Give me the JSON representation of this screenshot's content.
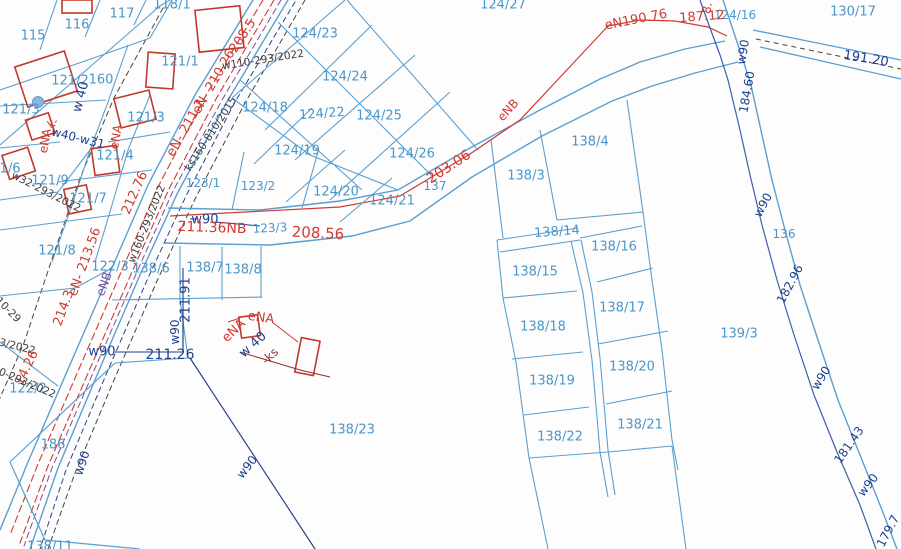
{
  "map": {
    "type": "cadastral-parcel-map",
    "background": "#fdfdfd",
    "colors": {
      "blue": "#4a96c8",
      "navy": "#1e3f8f",
      "red": "#d03a30",
      "darkred": "#8e2f2c",
      "purple": "#7a4fa0",
      "black": "#3c3c3c",
      "line_blue": "#5b9fd0",
      "building_red": "#c0392b",
      "well_fill": "#8ab6d9"
    },
    "labels": [
      {
        "t": "115",
        "x": 33,
        "y": 36,
        "r": 0,
        "c": "blue",
        "s": 13
      },
      {
        "t": "116",
        "x": 77,
        "y": 25,
        "r": 0,
        "c": "blue",
        "s": 13
      },
      {
        "t": "117",
        "x": 122,
        "y": 14,
        "r": 0,
        "c": "blue",
        "s": 13
      },
      {
        "t": "118/1",
        "x": 172,
        "y": 5,
        "r": 0,
        "c": "blue",
        "s": 13
      },
      {
        "t": "121/1",
        "x": 180,
        "y": 62,
        "r": 0,
        "c": "blue",
        "s": 13
      },
      {
        "t": "121/2",
        "x": 70,
        "y": 81,
        "r": 0,
        "c": "blue",
        "s": 13
      },
      {
        "t": "160",
        "x": 101,
        "y": 80,
        "r": 0,
        "c": "blue",
        "s": 13
      },
      {
        "t": "121/3",
        "x": 21,
        "y": 110,
        "r": 0,
        "c": "blue",
        "s": 13
      },
      {
        "t": "121/3",
        "x": 146,
        "y": 118,
        "r": 0,
        "c": "blue",
        "s": 13
      },
      {
        "t": "121/4",
        "x": 115,
        "y": 156,
        "r": 0,
        "c": "blue",
        "s": 13
      },
      {
        "t": "1/6",
        "x": 10,
        "y": 169,
        "r": 0,
        "c": "blue",
        "s": 13
      },
      {
        "t": "121/9",
        "x": 50,
        "y": 181,
        "r": 0,
        "c": "blue",
        "s": 13
      },
      {
        "t": "121/7",
        "x": 88,
        "y": 199,
        "r": 0,
        "c": "blue",
        "s": 13
      },
      {
        "t": "121/8",
        "x": 57,
        "y": 251,
        "r": 0,
        "c": "blue",
        "s": 13
      },
      {
        "t": "122/3",
        "x": 110,
        "y": 267,
        "r": 0,
        "c": "blue",
        "s": 13
      },
      {
        "t": "122/2",
        "x": 28,
        "y": 389,
        "r": 0,
        "c": "blue",
        "s": 13
      },
      {
        "t": "186",
        "x": 53,
        "y": 445,
        "r": 0,
        "c": "blue",
        "s": 13
      },
      {
        "t": "138/6",
        "x": 151,
        "y": 269,
        "r": 0,
        "c": "blue",
        "s": 13
      },
      {
        "t": "138/7",
        "x": 205,
        "y": 268,
        "r": 0,
        "c": "blue",
        "s": 13
      },
      {
        "t": "138/8",
        "x": 243,
        "y": 270,
        "r": 0,
        "c": "blue",
        "s": 13
      },
      {
        "t": "123/1",
        "x": 203,
        "y": 183,
        "r": 0,
        "c": "blue",
        "s": 12
      },
      {
        "t": "123/2",
        "x": 258,
        "y": 186,
        "r": 0,
        "c": "blue",
        "s": 12
      },
      {
        "t": "123/3",
        "x": 270,
        "y": 228,
        "r": -3,
        "c": "blue",
        "s": 12
      },
      {
        "t": "124/20",
        "x": 336,
        "y": 192,
        "r": 0,
        "c": "blue",
        "s": 13
      },
      {
        "t": "124/21",
        "x": 392,
        "y": 201,
        "r": 0,
        "c": "blue",
        "s": 13
      },
      {
        "t": "137",
        "x": 435,
        "y": 186,
        "r": 0,
        "c": "blue",
        "s": 12
      },
      {
        "t": "124/26",
        "x": 412,
        "y": 154,
        "r": 0,
        "c": "blue",
        "s": 13
      },
      {
        "t": "124/25",
        "x": 379,
        "y": 116,
        "r": 0,
        "c": "blue",
        "s": 13
      },
      {
        "t": "124/22",
        "x": 322,
        "y": 114,
        "r": -4,
        "c": "blue",
        "s": 13
      },
      {
        "t": "124/18",
        "x": 265,
        "y": 108,
        "r": 0,
        "c": "blue",
        "s": 13
      },
      {
        "t": "124/19",
        "x": 297,
        "y": 151,
        "r": 0,
        "c": "blue",
        "s": 13
      },
      {
        "t": "124/24",
        "x": 345,
        "y": 77,
        "r": 0,
        "c": "blue",
        "s": 13
      },
      {
        "t": "124/23",
        "x": 315,
        "y": 34,
        "r": 0,
        "c": "blue",
        "s": 13
      },
      {
        "t": "124/27",
        "x": 503,
        "y": 5,
        "r": 0,
        "c": "blue",
        "s": 13
      },
      {
        "t": "124/16",
        "x": 735,
        "y": 15,
        "r": 0,
        "c": "blue",
        "s": 12
      },
      {
        "t": "130/17",
        "x": 853,
        "y": 12,
        "r": 0,
        "c": "blue",
        "s": 13
      },
      {
        "t": "138/4",
        "x": 590,
        "y": 142,
        "r": 0,
        "c": "blue",
        "s": 13
      },
      {
        "t": "138/3",
        "x": 526,
        "y": 176,
        "r": 0,
        "c": "blue",
        "s": 13
      },
      {
        "t": "138/14",
        "x": 557,
        "y": 232,
        "r": -4,
        "c": "blue",
        "s": 13
      },
      {
        "t": "138/16",
        "x": 614,
        "y": 247,
        "r": 0,
        "c": "blue",
        "s": 13
      },
      {
        "t": "138/15",
        "x": 535,
        "y": 272,
        "r": 0,
        "c": "blue",
        "s": 13
      },
      {
        "t": "138/17",
        "x": 622,
        "y": 308,
        "r": 0,
        "c": "blue",
        "s": 13
      },
      {
        "t": "138/18",
        "x": 543,
        "y": 327,
        "r": 0,
        "c": "blue",
        "s": 13
      },
      {
        "t": "138/20",
        "x": 632,
        "y": 367,
        "r": 0,
        "c": "blue",
        "s": 13
      },
      {
        "t": "138/19",
        "x": 552,
        "y": 381,
        "r": 0,
        "c": "blue",
        "s": 13
      },
      {
        "t": "138/21",
        "x": 640,
        "y": 425,
        "r": 0,
        "c": "blue",
        "s": 13
      },
      {
        "t": "138/22",
        "x": 560,
        "y": 437,
        "r": 0,
        "c": "blue",
        "s": 13
      },
      {
        "t": "138/23",
        "x": 352,
        "y": 430,
        "r": 0,
        "c": "blue",
        "s": 13
      },
      {
        "t": "139/3",
        "x": 739,
        "y": 334,
        "r": 0,
        "c": "blue",
        "s": 13
      },
      {
        "t": "136",
        "x": 784,
        "y": 234,
        "r": 0,
        "c": "blue",
        "s": 12
      },
      {
        "t": "138/11",
        "x": 50,
        "y": 547,
        "r": 0,
        "c": "blue",
        "s": 13
      },
      {
        "t": "w90",
        "x": 205,
        "y": 220,
        "r": 0,
        "c": "navy",
        "s": 13
      },
      {
        "t": "211.91",
        "x": 186,
        "y": 300,
        "r": -90,
        "c": "navy",
        "s": 13
      },
      {
        "t": "w90",
        "x": 175,
        "y": 332,
        "r": -90,
        "c": "navy",
        "s": 12
      },
      {
        "t": "w90",
        "x": 102,
        "y": 352,
        "r": 0,
        "c": "navy",
        "s": 13
      },
      {
        "t": "211.26",
        "x": 170,
        "y": 355,
        "r": 0,
        "c": "navy",
        "s": 14
      },
      {
        "t": "w90",
        "x": 82,
        "y": 463,
        "r": -72,
        "c": "navy",
        "s": 12
      },
      {
        "t": "w90",
        "x": 247,
        "y": 467,
        "r": -52,
        "c": "navy",
        "s": 12
      },
      {
        "t": "w 40",
        "x": 81,
        "y": 97,
        "r": -75,
        "c": "navy",
        "s": 13
      },
      {
        "t": "w40-w31",
        "x": 78,
        "y": 138,
        "r": 14,
        "c": "navy",
        "s": 12
      },
      {
        "t": "184.60",
        "x": 747,
        "y": 92,
        "r": -80,
        "c": "navy",
        "s": 12
      },
      {
        "t": "w90",
        "x": 743,
        "y": 52,
        "r": -80,
        "c": "navy",
        "s": 12
      },
      {
        "t": "w90",
        "x": 763,
        "y": 205,
        "r": -62,
        "c": "navy",
        "s": 12
      },
      {
        "t": "182.96",
        "x": 790,
        "y": 284,
        "r": -62,
        "c": "navy",
        "s": 12
      },
      {
        "t": "w90",
        "x": 821,
        "y": 378,
        "r": -58,
        "c": "navy",
        "s": 12
      },
      {
        "t": "181.43",
        "x": 849,
        "y": 445,
        "r": -55,
        "c": "navy",
        "s": 12
      },
      {
        "t": "w90",
        "x": 868,
        "y": 485,
        "r": -52,
        "c": "navy",
        "s": 12
      },
      {
        "t": "179.7",
        "x": 888,
        "y": 531,
        "r": -62,
        "c": "navy",
        "s": 12
      },
      {
        "t": "191.20",
        "x": 866,
        "y": 59,
        "r": 9,
        "c": "navy",
        "s": 13
      },
      {
        "t": "w 40",
        "x": 253,
        "y": 345,
        "r": -42,
        "c": "navy",
        "s": 13
      },
      {
        "t": "eN190.76",
        "x": 636,
        "y": 20,
        "r": -11,
        "c": "red",
        "s": 13
      },
      {
        "t": "187.12",
        "x": 702,
        "y": 17,
        "r": -4,
        "c": "red",
        "s": 13
      },
      {
        "t": "8.",
        "x": 707,
        "y": 8,
        "r": -80,
        "c": "red",
        "s": 12
      },
      {
        "t": "203.06",
        "x": 449,
        "y": 167,
        "r": -33,
        "c": "red",
        "s": 14
      },
      {
        "t": "208.56",
        "x": 318,
        "y": 233,
        "r": 3,
        "c": "red",
        "s": 15
      },
      {
        "t": "211.36NB",
        "x": 212,
        "y": 228,
        "r": 2,
        "c": "red",
        "s": 14
      },
      {
        "t": "208.5",
        "x": 243,
        "y": 36,
        "r": -57,
        "c": "red",
        "s": 13
      },
      {
        "t": "eN- 210.26",
        "x": 214,
        "y": 82,
        "r": -60,
        "c": "red",
        "s": 13
      },
      {
        "t": "eN- 211.2",
        "x": 186,
        "y": 128,
        "r": -60,
        "c": "red",
        "s": 13
      },
      {
        "t": "212.76",
        "x": 135,
        "y": 193,
        "r": -66,
        "c": "red",
        "s": 13
      },
      {
        "t": "eN- 213.56",
        "x": 85,
        "y": 262,
        "r": -70,
        "c": "red",
        "s": 13
      },
      {
        "t": "214.3",
        "x": 64,
        "y": 308,
        "r": -70,
        "c": "red",
        "s": 13
      },
      {
        "t": "14.26",
        "x": 27,
        "y": 368,
        "r": -64,
        "c": "red",
        "s": 13
      },
      {
        "t": "eNA",
        "x": 116,
        "y": 137,
        "r": -80,
        "c": "red",
        "s": 12
      },
      {
        "t": "eNA",
        "x": 45,
        "y": 141,
        "r": -80,
        "c": "red",
        "s": 12
      },
      {
        "t": "k-",
        "x": 53,
        "y": 123,
        "r": -35,
        "c": "red",
        "s": 11
      },
      {
        "t": "eNA",
        "x": 261,
        "y": 318,
        "r": 8,
        "c": "red",
        "s": 13
      },
      {
        "t": "eNA",
        "x": 234,
        "y": 331,
        "r": -44,
        "c": "red",
        "s": 13
      },
      {
        "t": "eNB",
        "x": 508,
        "y": 110,
        "r": -48,
        "c": "red",
        "s": 12
      },
      {
        "t": "-ks",
        "x": 270,
        "y": 356,
        "r": -44,
        "c": "darkred",
        "s": 12
      },
      {
        "t": "eNB",
        "x": 104,
        "y": 284,
        "r": -70,
        "c": "purple",
        "s": 12
      },
      {
        "t": "w110-293/2022",
        "x": 263,
        "y": 60,
        "r": -9,
        "c": "black",
        "s": 10.5
      },
      {
        "t": "ks160-810/2015",
        "x": 211,
        "y": 134,
        "r": -57,
        "c": "black",
        "s": 10.5
      },
      {
        "t": "w32-293/2022",
        "x": 46,
        "y": 192,
        "r": 27,
        "c": "black",
        "s": 10.5
      },
      {
        "t": "w160-293/2022",
        "x": 147,
        "y": 224,
        "r": -68,
        "c": "black",
        "s": 10.5
      },
      {
        "t": "10-293/2022",
        "x": 24,
        "y": 382,
        "r": 23,
        "c": "black",
        "s": 10.5
      },
      {
        "t": "93/2022",
        "x": 14,
        "y": 346,
        "r": 14,
        "c": "black",
        "s": 10.5
      },
      {
        "t": "10-29",
        "x": 8,
        "y": 310,
        "r": 45,
        "c": "black",
        "s": 10.5
      }
    ]
  }
}
